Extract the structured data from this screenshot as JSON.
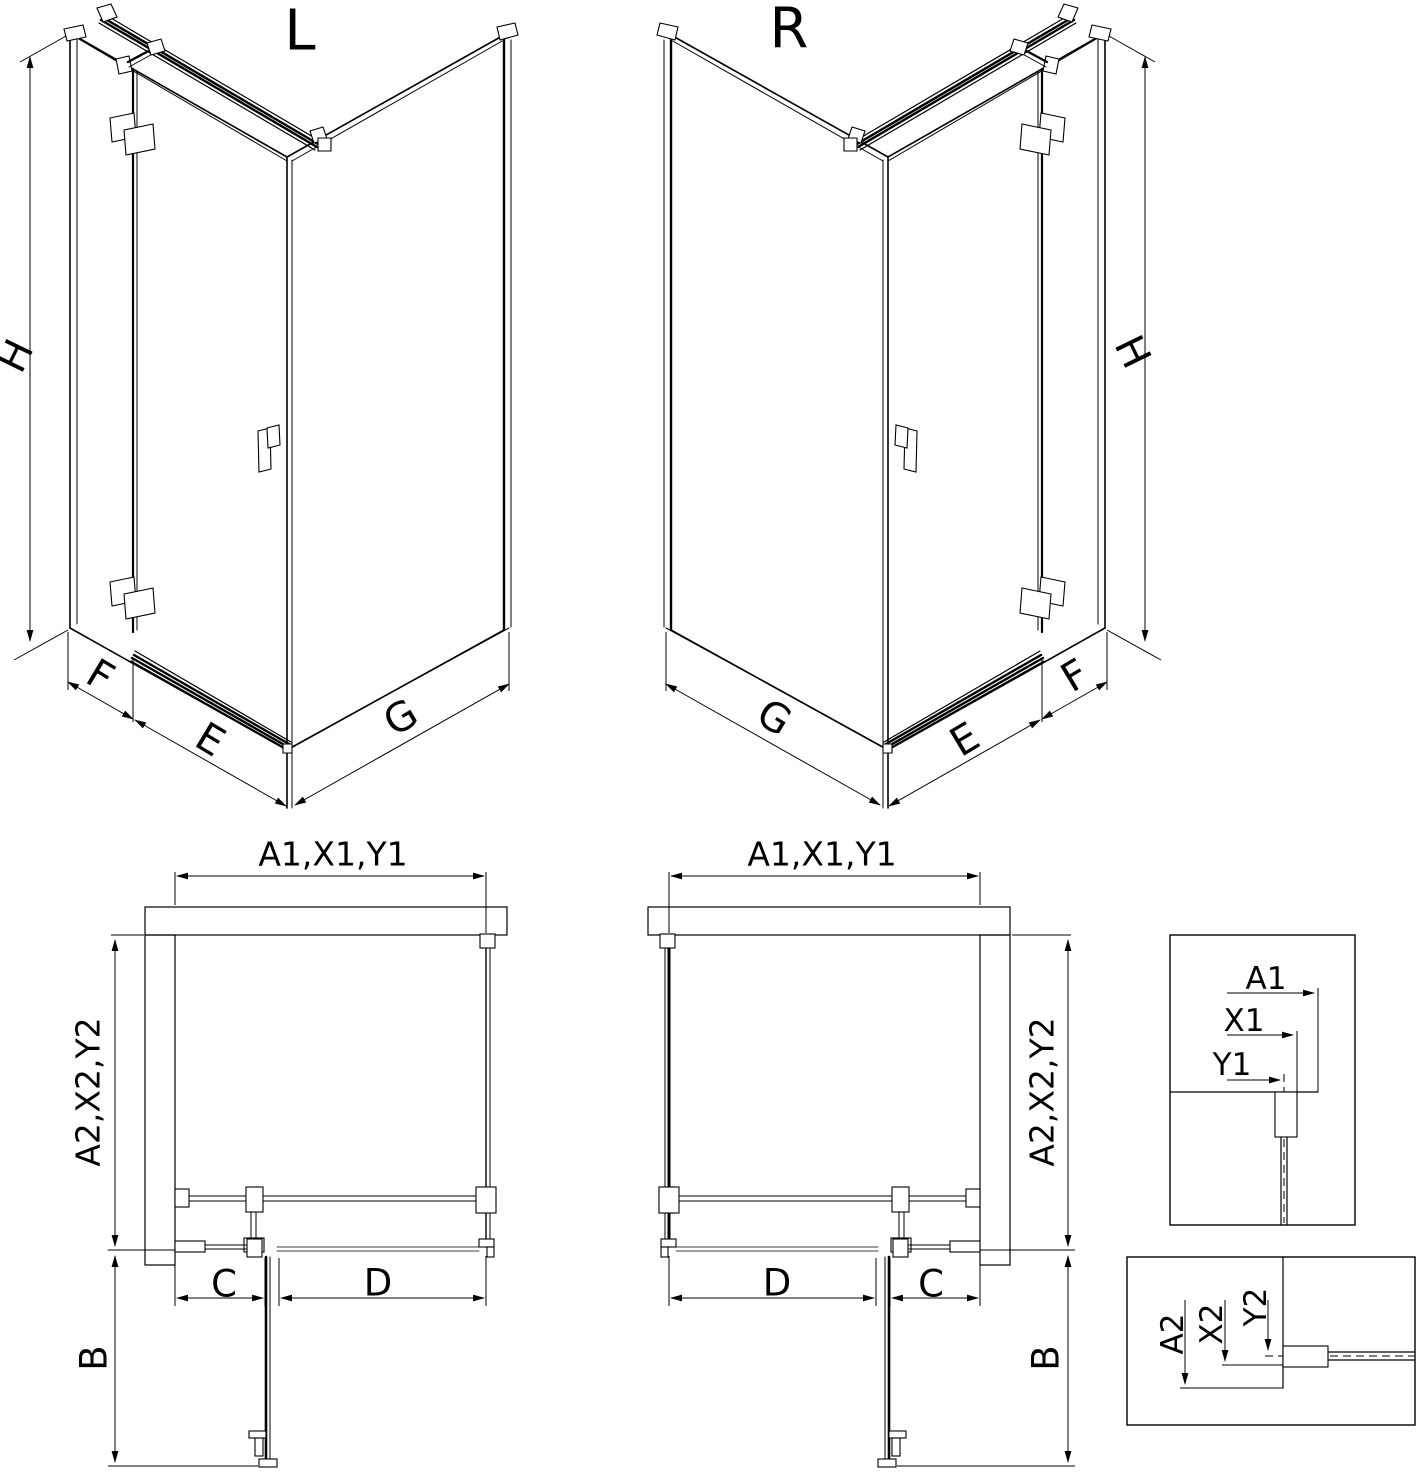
{
  "drawing": {
    "type": "technical-dimension-diagram",
    "subject": "corner shower enclosure with hinged door, left (L) and right (R) versions",
    "colors": {
      "line": "#000000",
      "hatch": "#3a3a3a",
      "background": "#ffffff"
    },
    "iso_left": {
      "title": "L",
      "height": "H",
      "fixed": "F",
      "door": "E",
      "panel": "G"
    },
    "iso_right": {
      "title": "R",
      "height": "H",
      "fixed": "F",
      "door": "E",
      "panel": "G"
    },
    "plan_left": {
      "width": "A1,X1,Y1",
      "depth": "A2,X2,Y2",
      "swing": "B",
      "fixed": "C",
      "opening": "D"
    },
    "plan_right": {
      "width": "A1,X1,Y1",
      "depth": "A2,X2,Y2",
      "swing": "B",
      "fixed": "C",
      "opening": "D"
    },
    "detail_top": {
      "a1": "A1",
      "x1": "X1",
      "y1": "Y1"
    },
    "detail_bottom": {
      "a2": "A2",
      "x2": "X2",
      "y2": "Y2"
    }
  }
}
